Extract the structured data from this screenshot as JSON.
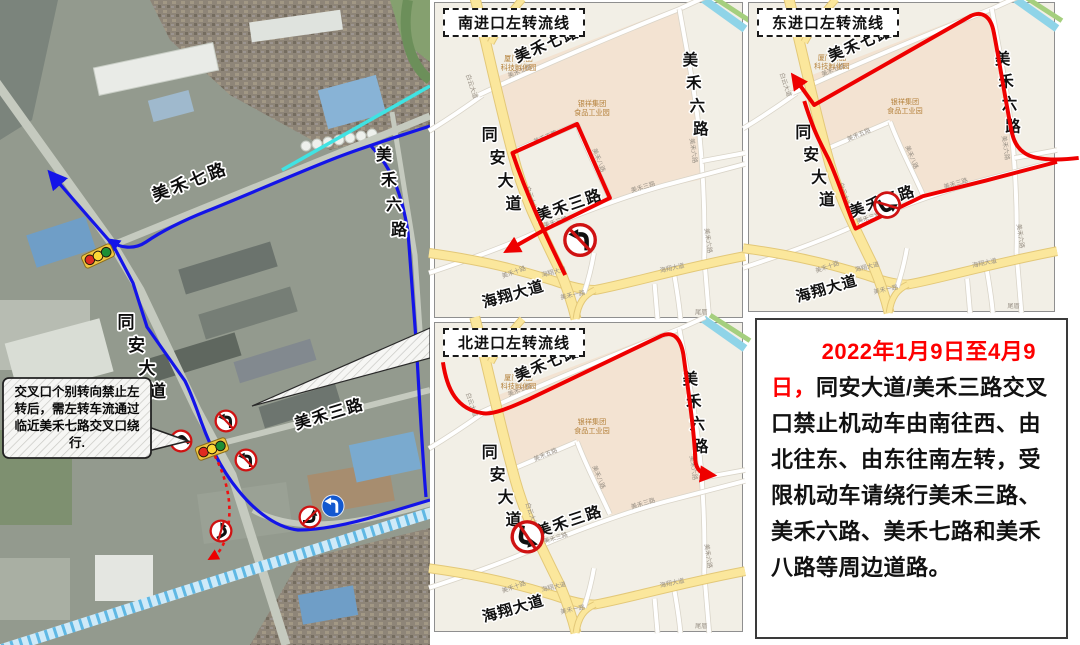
{
  "colors": {
    "route_red": "#ee0000",
    "route_blue": "#1414e8",
    "cyan_line": "#3fe3e3",
    "expressway_blue": "#3aa7dd",
    "notice_red": "#fe0000",
    "inset_bg": "#f2efe6",
    "inset_block_pink": "#f3e3d2",
    "inset_road_yellow": "#fbe79c"
  },
  "left_map": {
    "road_labels": {
      "mei7": "美禾七路",
      "mei6": "美禾六路",
      "tongan": "同安大道",
      "mei3": "美禾三路"
    },
    "callout": {
      "lines": [
        "交叉口个别转向禁止左",
        "转后，需左转车流通过",
        "临近美禾七路交叉口绕",
        "行."
      ]
    },
    "icons": {
      "no_left_turn_sign": "no-left-turn-sign",
      "left_turn_sign": "left-turn-allowed-sign",
      "traffic_light": "traffic-light"
    }
  },
  "panels": [
    {
      "key": "south",
      "title": "南进口左转流线"
    },
    {
      "key": "east",
      "title": "东进口左转流线"
    },
    {
      "key": "north",
      "title": "北进口左转流线"
    }
  ],
  "inset_map": {
    "major_labels": {
      "mei7": "美禾七路",
      "mei6": "美禾六路",
      "tongan": "同安大道",
      "mei3": "美禾三路",
      "haixiang": "海翔大道"
    },
    "minor_labels": {
      "mei7": "美禾七路",
      "mei5": "美禾五路",
      "mei8": "美禾八路",
      "mei3": "美禾三路",
      "baiyun": "白云大道",
      "mei6": "美禾六路",
      "haixiang": "海翔大道",
      "mei1": "美禾一路",
      "mei10": "美禾十路",
      "weicuo": "尾厝"
    },
    "poi_labels": {
      "incubator": [
        "厦门食品",
        "科技孵化园"
      ],
      "yinxiang": [
        "银祥集团",
        "食品工业园"
      ]
    }
  },
  "notice": {
    "date_highlight": "2022年1月9日至4月9日，",
    "body": "同安大道/美禾三路交叉口禁止机动车由南往西、由北往东、由东往南左转，受限机动车请绕行美禾三路、美禾六路、美禾七路和美禾八路等周边道路。"
  }
}
